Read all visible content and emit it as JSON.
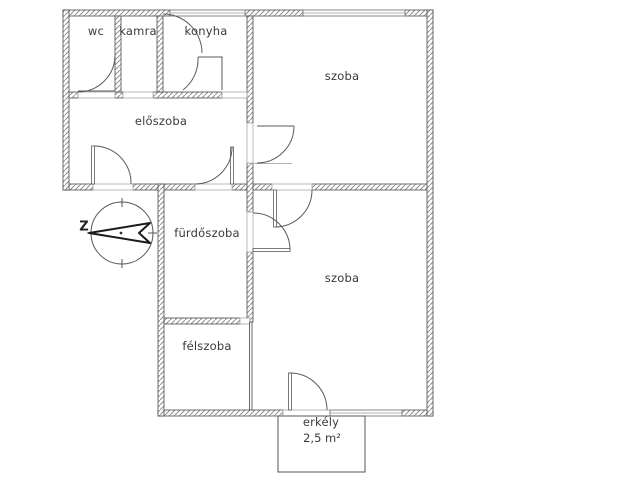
{
  "document": {
    "type": "apartment floor plan"
  },
  "rooms": {
    "wc": {
      "label": "wc"
    },
    "kamra": {
      "label": "kamra"
    },
    "konyha": {
      "label": "konyha"
    },
    "szoba_top": {
      "label": "szoba"
    },
    "eloszoba": {
      "label": "előszoba"
    },
    "furdoszoba": {
      "label": "fürdőszoba"
    },
    "felszoba": {
      "label": "félszoba"
    },
    "szoba_bottom": {
      "label": "szoba"
    },
    "erkely": {
      "label": "erkély",
      "area": "2,5 m²"
    }
  },
  "compass": {
    "label": "Z"
  },
  "colors": {
    "background": "#ffffff",
    "wall_outline": "#4a4a4a",
    "wall_hatch": "#8f8f8f",
    "door_line": "#5a5a5a",
    "text": "#3a3a3a"
  }
}
